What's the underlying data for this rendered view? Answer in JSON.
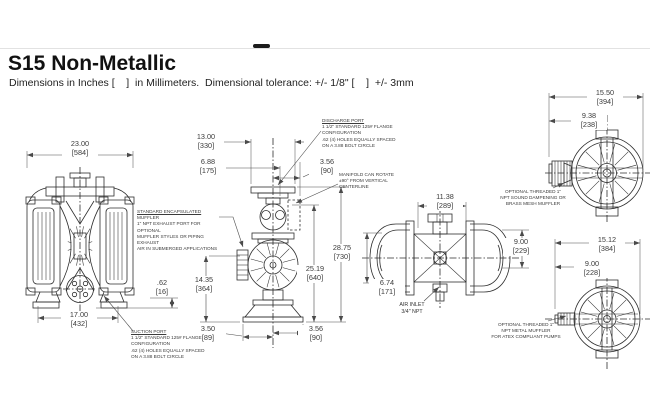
{
  "header": {
    "title": "S15 Non-Metallic",
    "subtitle": "Dimensions in Inches [    ]  in Millimeters.  Dimensional tolerance: +/- 1/8\" [    ]  +/- 3mm"
  },
  "dimensions": {
    "front_width": {
      "in": "23.00",
      "mm": "[584]"
    },
    "front_bolt_span": {
      "in": "17.00",
      "mm": "[432]"
    },
    "front_port_offset": {
      "in": ".62",
      "mm": "[16]"
    },
    "elev_manifold_width": {
      "in": "13.00",
      "mm": "[330]"
    },
    "elev_flange_width": {
      "in": "6.88",
      "mm": "[175]"
    },
    "elev_port_depth_top": {
      "in": "3.56",
      "mm": "[90]"
    },
    "elev_total_height": {
      "in": "28.75",
      "mm": "[730]"
    },
    "elev_port_height": {
      "in": "25.19",
      "mm": "[640]"
    },
    "elev_inlet_height": {
      "in": "14.35",
      "mm": "[364]"
    },
    "elev_base_left": {
      "in": "3.50",
      "mm": "[89]"
    },
    "elev_base_right": {
      "in": "3.56",
      "mm": "[90]"
    },
    "plan_width": {
      "in": "11.38",
      "mm": "[289]"
    },
    "plan_depth": {
      "in": "6.74",
      "mm": "[171]"
    },
    "plan_height": {
      "in": "9.00",
      "mm": "[229]"
    },
    "end_sound_width": {
      "in": "15.50",
      "mm": "[394]"
    },
    "end_sound_offset": {
      "in": "9.38",
      "mm": "[238]"
    },
    "end_atex_width": {
      "in": "15.12",
      "mm": "[384]"
    },
    "end_atex_offset": {
      "in": "9.00",
      "mm": "[228]"
    }
  },
  "notes": {
    "muffler": {
      "title_u": "STANDARD ENCAPSULATED",
      "title_rest": " MUFFLER",
      "line1": "1\" NPT EXHAUST PORT FOR OPTIONAL",
      "line2": "MUFFLER STYLES OR PIPING EXHAUST",
      "line3": "AIR IN SUBMERGED APPLICATIONS"
    },
    "suction": {
      "title": "SUCTION PORT",
      "line1": "1 1/2\" STANDARD 125# FLANGE",
      "line2": "CONFIGURATION",
      "line3": ".62 (4) HOLES EQUALLY SPACED",
      "line4": "ON A 3.88 BOLT CIRCLE"
    },
    "discharge": {
      "title": "DISCHARGE PORT",
      "line1": "1 1/2\" STANDARD 125# FLANGE",
      "line2": "CONFIGURATION",
      "line3": ".62 (4) HOLES EQUALLY SPACED",
      "line4": "ON A 3.88 BOLT CIRCLE"
    },
    "manifold": {
      "line1": "MANIFOLD CAN ROTATE",
      "line2": "±90° FROM VERTICAL",
      "line3": "CENTERLINE"
    },
    "air_inlet": {
      "line1": "AIR INLET",
      "line2": "3/4\" NPT"
    },
    "sound_muffler": {
      "line1": "OPTIONAL THREADED 1\"",
      "line2": "NPT SOUND DAMPENING OR",
      "line3": "BRASS MESH MUFFLER"
    },
    "atex_muffler": {
      "line1": "OPTIONAL THREADED 1\"",
      "line2": "NPT METAL MUFFLER",
      "line3": "FOR ATEX COMPLIANT PUMPS"
    }
  }
}
